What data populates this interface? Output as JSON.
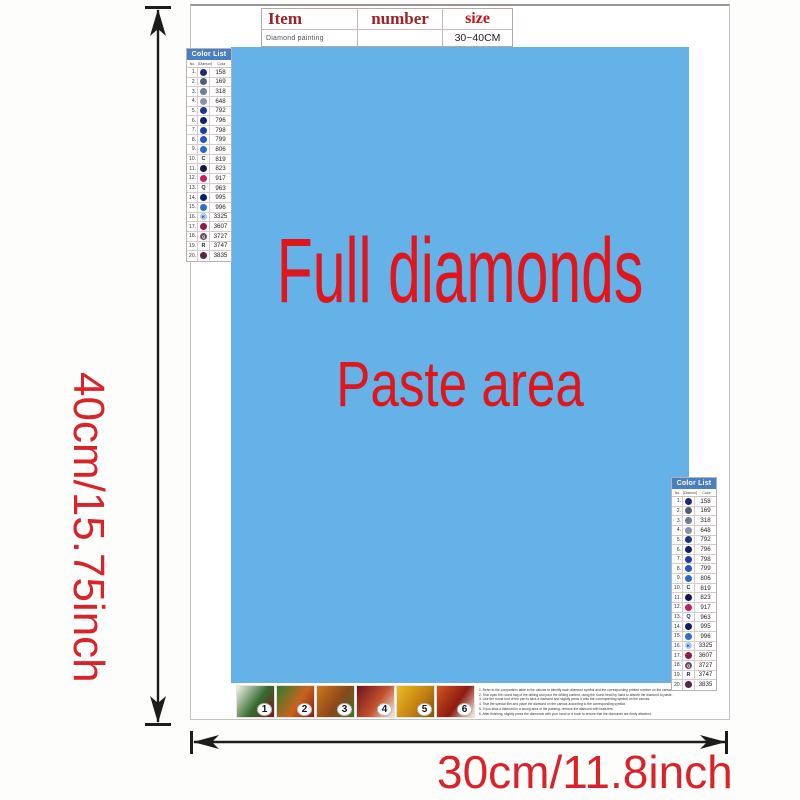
{
  "dimensions": {
    "height_label": "40cm/15.75inch",
    "width_label": "30cm/11.8inch",
    "label_color": "#d9232b"
  },
  "item_table": {
    "headers": [
      "Item",
      "number",
      "size"
    ],
    "row": {
      "item": "Diamond painting",
      "number": "",
      "size": "30~40CM"
    }
  },
  "paste_area": {
    "line1": "Full diamonds",
    "line2": "Paste area",
    "text_color": "#e0161d",
    "bg_color": "#64b2e8"
  },
  "color_list": {
    "title": "Color List",
    "title_bg": "#4a7fc1",
    "columns": [
      "No.",
      "Diamond",
      "Color"
    ],
    "rows": [
      {
        "no": "1.",
        "code": "158",
        "circle": "#1c2a72"
      },
      {
        "no": "2.",
        "code": "169",
        "circle": "#4f5f78"
      },
      {
        "no": "3.",
        "code": "318",
        "circle": "#6e7d92"
      },
      {
        "no": "4.",
        "code": "648",
        "circle": "#8793a3"
      },
      {
        "no": "5.",
        "code": "792",
        "circle": "#1f3390"
      },
      {
        "no": "6.",
        "code": "796",
        "circle": "#131f66"
      },
      {
        "no": "7.",
        "code": "798",
        "circle": "#1e3da0"
      },
      {
        "no": "8.",
        "code": "799",
        "circle": "#2a53be"
      },
      {
        "no": "9.",
        "code": "806",
        "circle": "#2a6ac0"
      },
      {
        "no": "10.",
        "code": "819",
        "letter": "C"
      },
      {
        "no": "11.",
        "code": "823",
        "circle": "#10164a"
      },
      {
        "no": "12.",
        "code": "917",
        "circle": "#c22064"
      },
      {
        "no": "13.",
        "code": "963",
        "letter": "Q"
      },
      {
        "no": "14.",
        "code": "995",
        "circle": "#0c1c60"
      },
      {
        "no": "15.",
        "code": "996",
        "circle": "#2e6ecc"
      },
      {
        "no": "16.",
        "code": "3325",
        "circle": "#a8cbee",
        "letter": "K",
        "letter_color": "#1a2a4a"
      },
      {
        "no": "17.",
        "code": "3607",
        "circle": "#8c1a4a"
      },
      {
        "no": "18.",
        "code": "3727",
        "circle": "#6e4a66",
        "letter": "Q",
        "letter_color": "#ffffff"
      },
      {
        "no": "19.",
        "code": "3747",
        "letter": "R"
      },
      {
        "no": "20.",
        "code": "3835",
        "circle": "#5a2348"
      }
    ]
  },
  "steps": {
    "items": [
      {
        "num": "1",
        "colors": [
          "#f5f2ec",
          "#356b2f",
          "#7c1822"
        ]
      },
      {
        "num": "2",
        "colors": [
          "#2f7a30",
          "#c8641e",
          "#871c18"
        ]
      },
      {
        "num": "3",
        "colors": [
          "#d2771e",
          "#8a4718",
          "#41722a"
        ]
      },
      {
        "num": "4",
        "colors": [
          "#6d1420",
          "#c2512c",
          "#f3ece2"
        ]
      },
      {
        "num": "5",
        "colors": [
          "#eabc24",
          "#c58212",
          "#7c560c"
        ]
      },
      {
        "num": "6",
        "colors": [
          "#d2571e",
          "#8c1c10",
          "#f5efe6"
        ]
      }
    ]
  },
  "instructions": {
    "lines": [
      "1. Refer to the comparison table in the canvas to identify each diamond symbol and the corresponding printed number on the canvas.",
      "2. Tear open the round bag of the drilling and pour the drilling content, using the round head by hand to absorb the diamond to paste.",
      "3. Use the round end of the pen to stick a diamond and slightly press it onto the corresponding symbol on the canvas.",
      "4. Tear the special film and place the diamond on the canvas according to the corresponding symbol.",
      "5. If you stick a diamond in a wrong area of the painting, remove the diamond with tweezers.",
      "6. After finishing, slightly press the diamonds with your hand or a book to ensure that the diamonds are firmly attached."
    ]
  }
}
